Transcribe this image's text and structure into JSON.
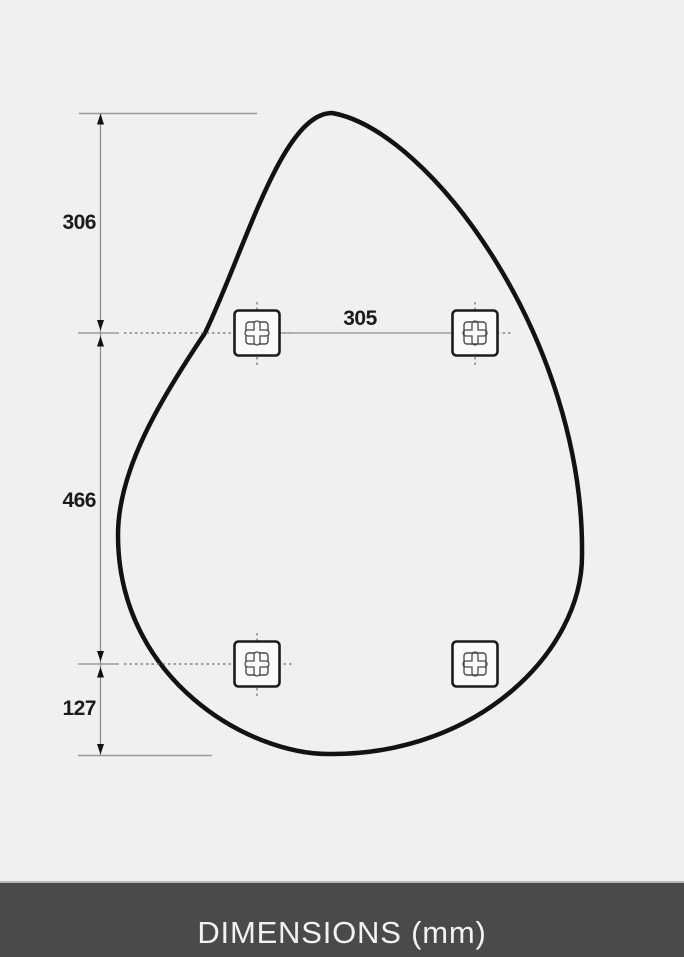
{
  "diagram": {
    "unit": "mm",
    "labels": {
      "top_offset": "306",
      "hole_spacing": "305",
      "middle_span": "466",
      "bottom_offset": "127"
    }
  },
  "footer": {
    "title": "DIMENSIONS (mm)"
  },
  "colors": {
    "background": "#f0f0f0",
    "outline": "#121212",
    "dimension_lines": "#8e8e8e",
    "dashed_lines": "#6e6e6e",
    "labels": "#1b1b1b",
    "footer_background": "#4a4a4a",
    "footer_border": "#b5b5b5",
    "footer_text": "#f2f2f2"
  }
}
